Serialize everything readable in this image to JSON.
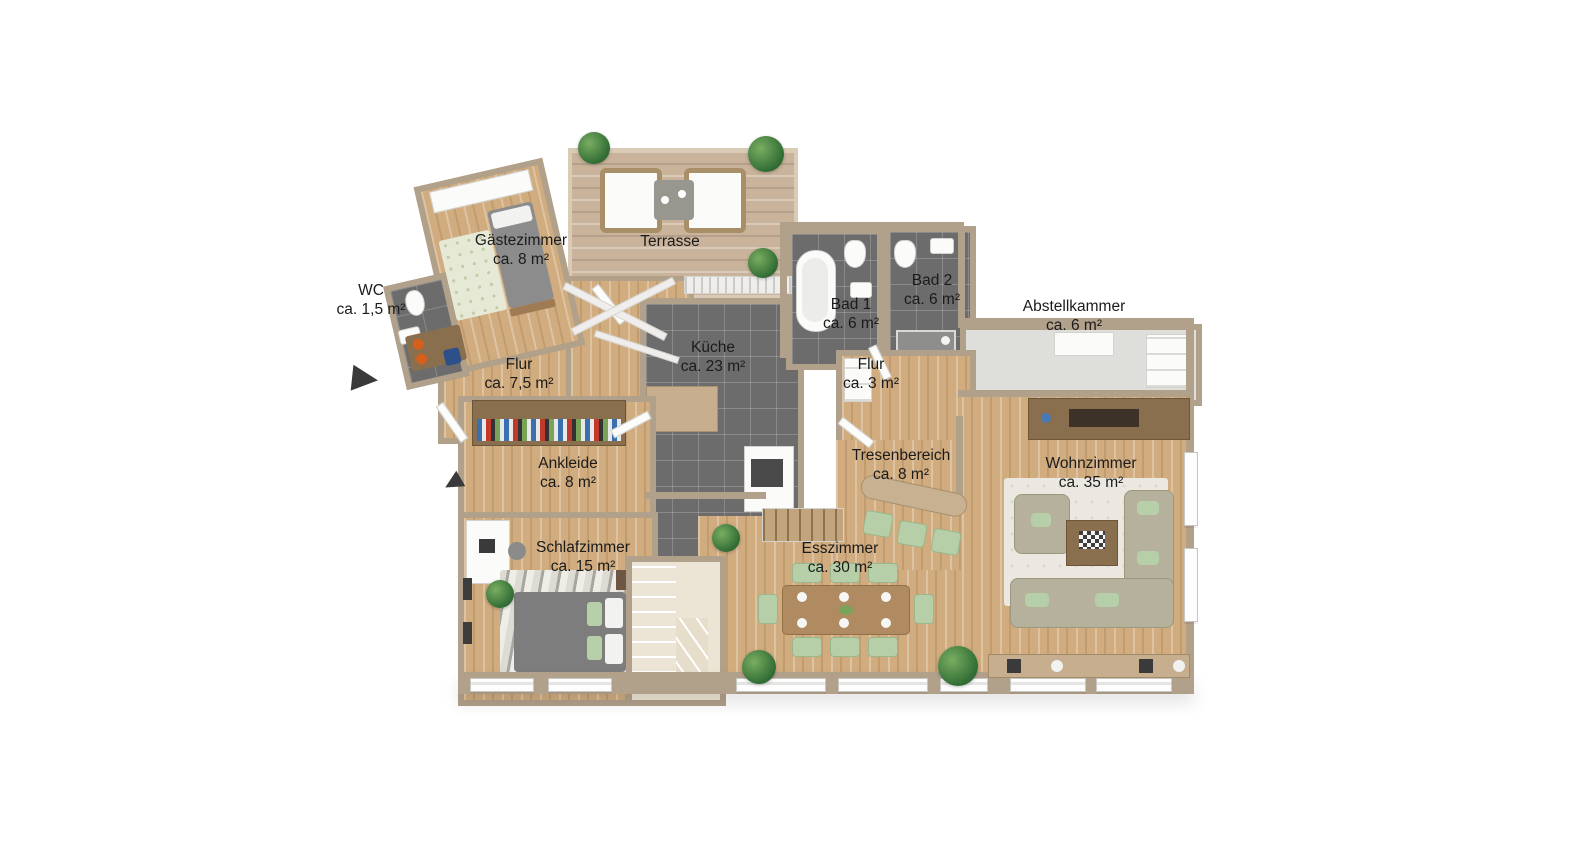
{
  "plan": {
    "title": "3D-Grundriss Erdgeschoss",
    "rooms": [
      {
        "key": "gaestezimmer",
        "name": "Gästezimmer",
        "area": "ca. 8 m²"
      },
      {
        "key": "terrasse",
        "name": "Terrasse",
        "area": ""
      },
      {
        "key": "wc",
        "name": "WC",
        "area": "ca. 1,5 m²"
      },
      {
        "key": "bad1",
        "name": "Bad 1",
        "area": "ca. 6 m²"
      },
      {
        "key": "bad2",
        "name": "Bad 2",
        "area": "ca. 6 m²"
      },
      {
        "key": "abstellkammer",
        "name": "Abstellkammer",
        "area": "ca. 6 m²"
      },
      {
        "key": "flur-gross",
        "name": "Flur",
        "area": "ca. 7,5 m²"
      },
      {
        "key": "kueche",
        "name": "Küche",
        "area": "ca. 23 m²"
      },
      {
        "key": "flur-klein",
        "name": "Flur",
        "area": "ca. 3 m²"
      },
      {
        "key": "ankleide",
        "name": "Ankleide",
        "area": "ca. 8 m²"
      },
      {
        "key": "tresenbereich",
        "name": "Tresenbereich",
        "area": "ca. 8 m²"
      },
      {
        "key": "wohnzimmer",
        "name": "Wohnzimmer",
        "area": "ca. 35 m²"
      },
      {
        "key": "schlafzimmer",
        "name": "Schlafzimmer",
        "area": "ca. 15 m²"
      },
      {
        "key": "esszimmer",
        "name": "Esszimmer",
        "area": "ca. 30 m²"
      }
    ],
    "colors": {
      "background": "#ffffff",
      "wood_floor": "#d0ac7f",
      "terrace_deck": "#c9b39b",
      "tile_floor": "#6c6c6c",
      "wall_tan": "#b1a08a",
      "wall_white": "#efeeec",
      "furniture_green": "#b6cfa8",
      "sofa_beige": "#b5b19c",
      "label_text": "#1b1b1b"
    },
    "icons": {
      "entrance_arrow": "triangle-right",
      "plant": "green-circle"
    }
  }
}
